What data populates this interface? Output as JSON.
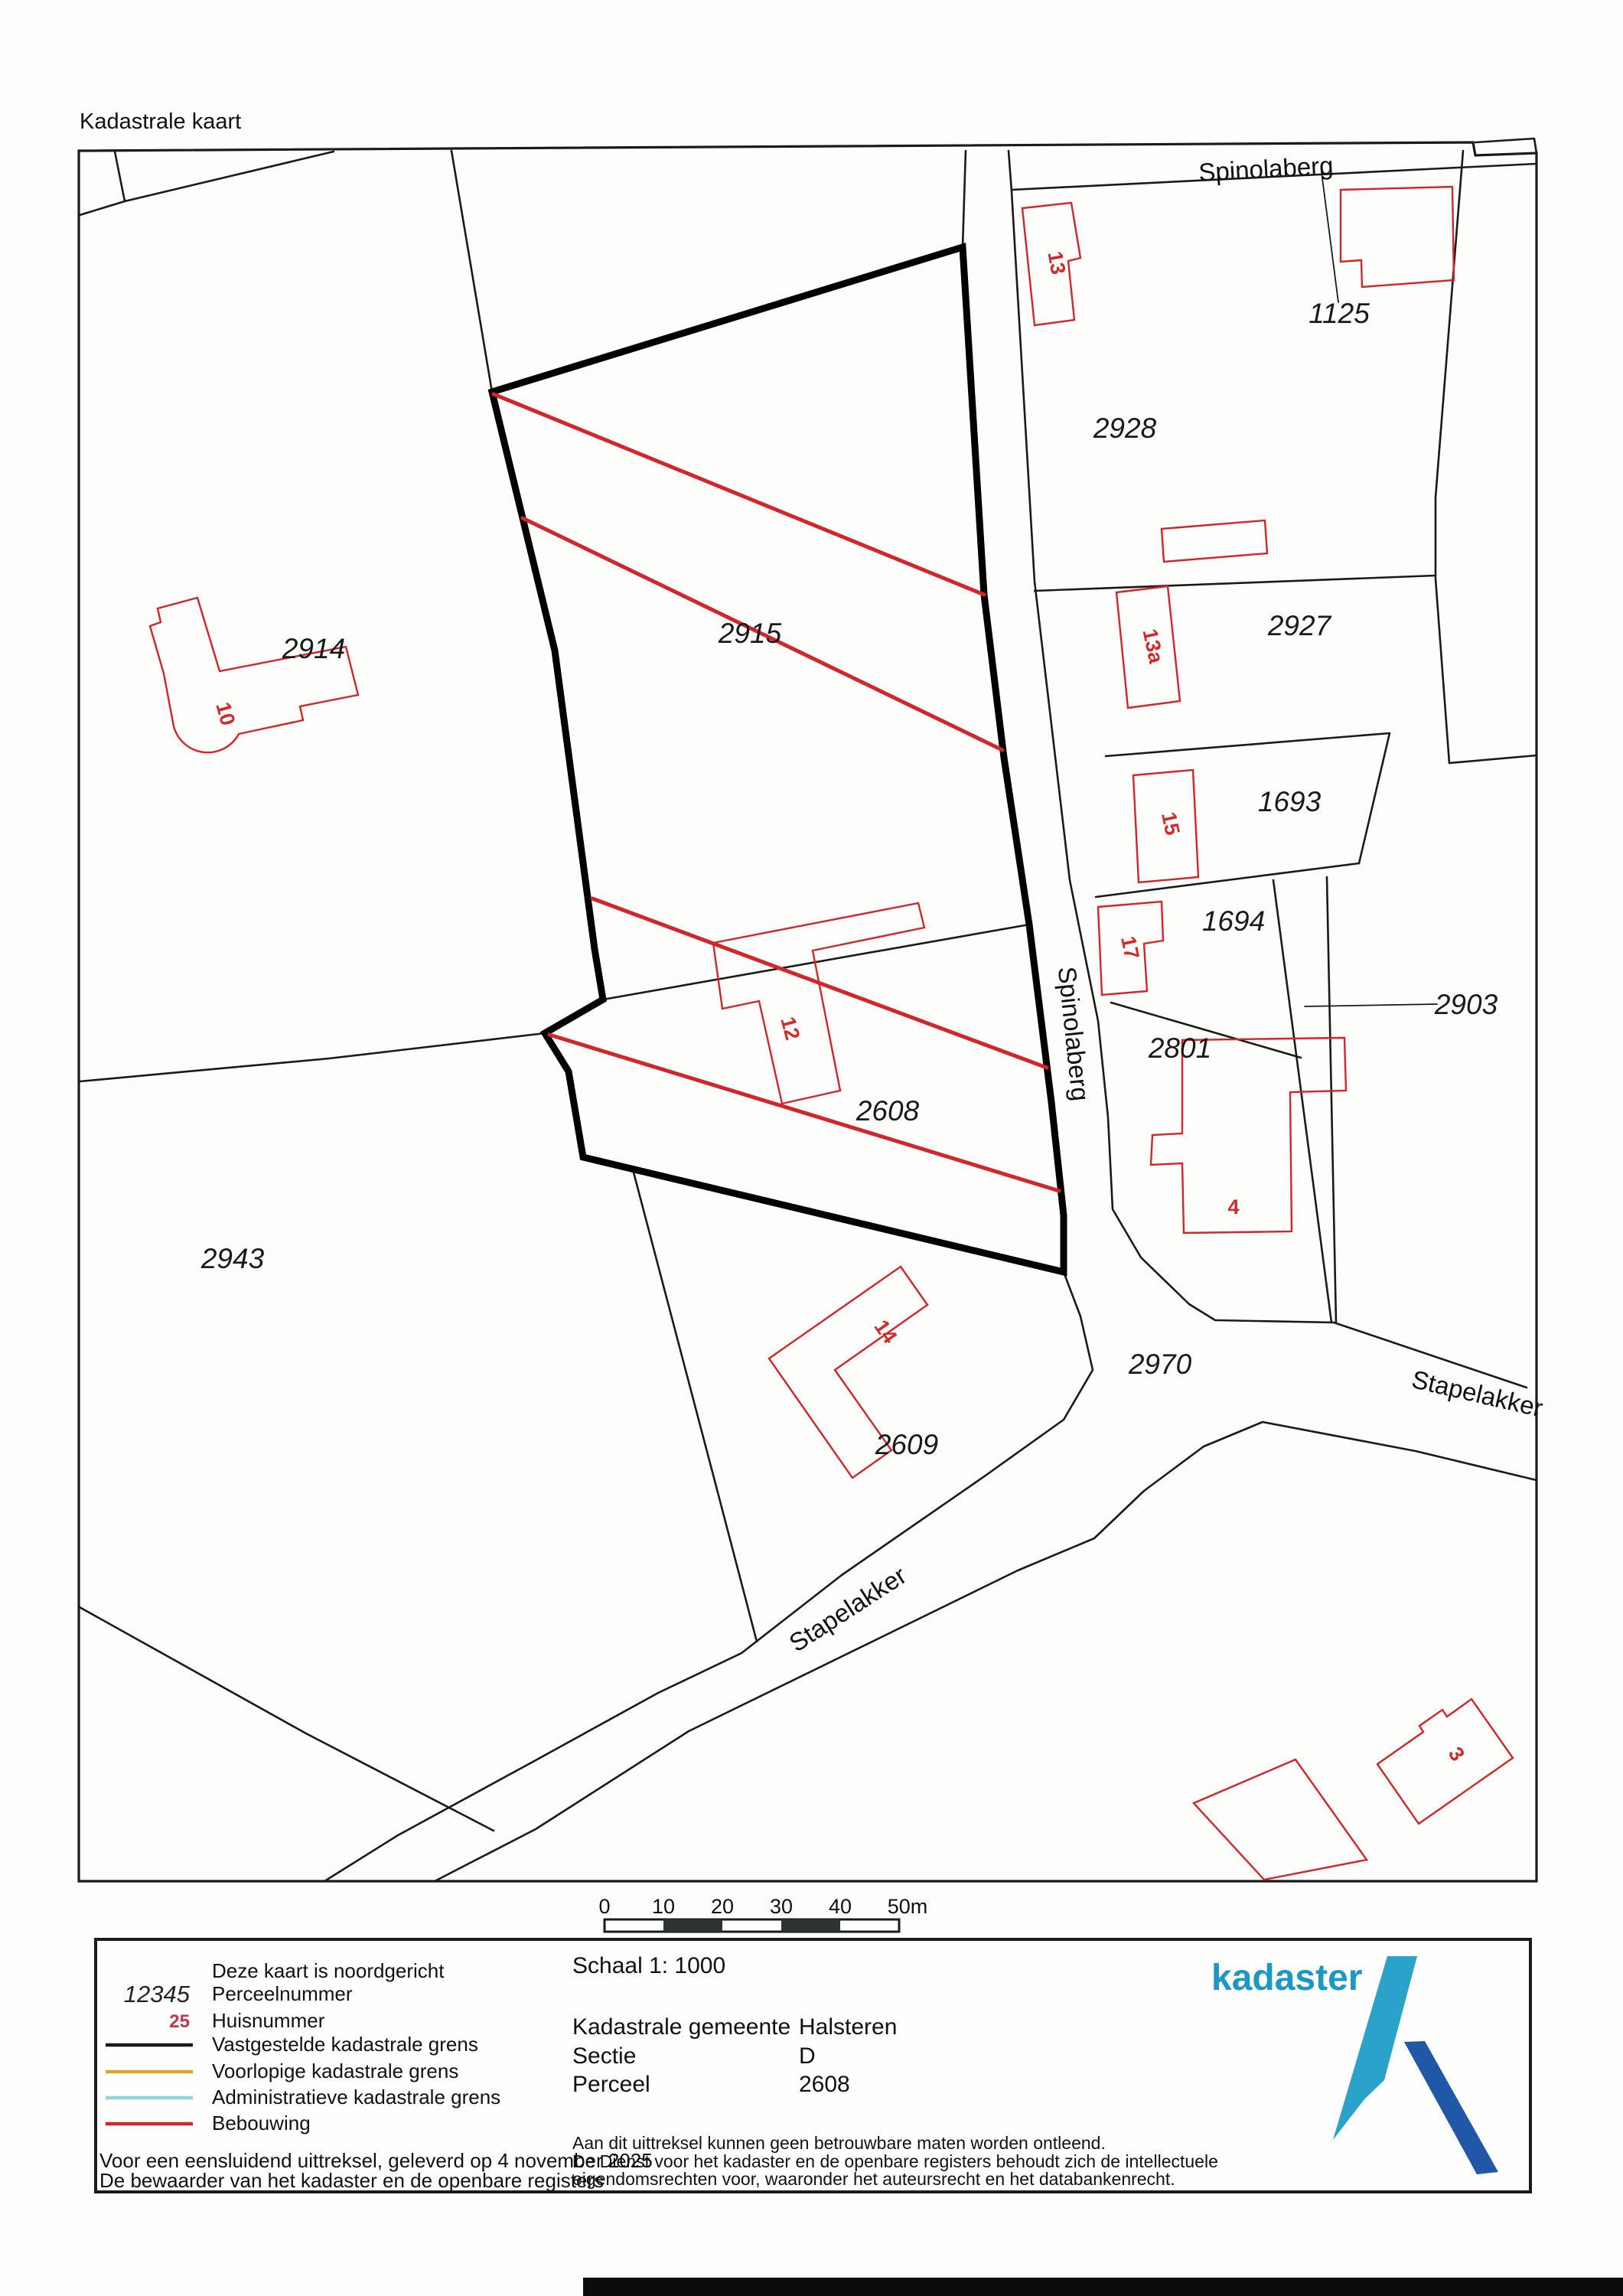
{
  "title": "Kadastrale kaart",
  "map": {
    "streets": {
      "spinolaberg_top": "Spinolaberg",
      "spinolaberg_side": "Spinolaberg",
      "stapelakker_sw": "Stapelakker",
      "stapelakker_e": "Stapelakker"
    },
    "parcels": [
      {
        "number": "2914"
      },
      {
        "number": "2915"
      },
      {
        "number": "2928"
      },
      {
        "number": "2927"
      },
      {
        "number": "1693"
      },
      {
        "number": "1694"
      },
      {
        "number": "2608"
      },
      {
        "number": "2801"
      },
      {
        "number": "2903"
      },
      {
        "number": "2943"
      },
      {
        "number": "2609"
      },
      {
        "number": "2970"
      },
      {
        "number": "1125"
      }
    ],
    "house_numbers": [
      {
        "number": "13"
      },
      {
        "number": "13a"
      },
      {
        "number": "15"
      },
      {
        "number": "17"
      },
      {
        "number": "10"
      },
      {
        "number": "12"
      },
      {
        "number": "4"
      },
      {
        "number": "14"
      },
      {
        "number": "3"
      }
    ]
  },
  "scalebar": {
    "ticks": [
      "0",
      "10",
      "20",
      "30",
      "40",
      "50m"
    ]
  },
  "legend": {
    "north_note": "Deze kaart is noordgericht",
    "perceel_sample": "12345",
    "perceel_label": "Perceelnummer",
    "huis_sample": "25",
    "huis_label": "Huisnummer",
    "line1_label": "Vastgestelde kadastrale grens",
    "line2_label": "Voorlopige kadastrale grens",
    "line3_label": "Administratieve kadastrale grens",
    "line4_label": "Bebouwing",
    "footer_line1": "Voor een eensluidend uittreksel, geleverd op 4 november 2025",
    "footer_line2": "De bewaarder van het kadaster en de openbare registers",
    "colors": {
      "vastgesteld": "#1a1a1a",
      "voorlopig": "#e0a62b",
      "administratief": "#8ed7da",
      "bebouwing": "#d0262c"
    }
  },
  "info": {
    "schaal": "Schaal 1: 1000",
    "gemeente_label": "Kadastrale gemeente",
    "gemeente_value": "Halsteren",
    "sectie_label": "Sectie",
    "sectie_value": "D",
    "perceel_label": "Perceel",
    "perceel_value": "2608",
    "disclaimer_line1": "Aan dit uittreksel kunnen geen betrouwbare maten worden ontleend.",
    "disclaimer_line2": "De Dienst voor het kadaster en de openbare registers behoudt zich de intellectuele",
    "disclaimer_line3": "eigendomsrechten voor, waaronder het auteursrecht en het databankenrecht."
  },
  "logo": {
    "text": "kadaster",
    "light_blue": "#2ba2c9",
    "dark_blue": "#2057a7"
  }
}
